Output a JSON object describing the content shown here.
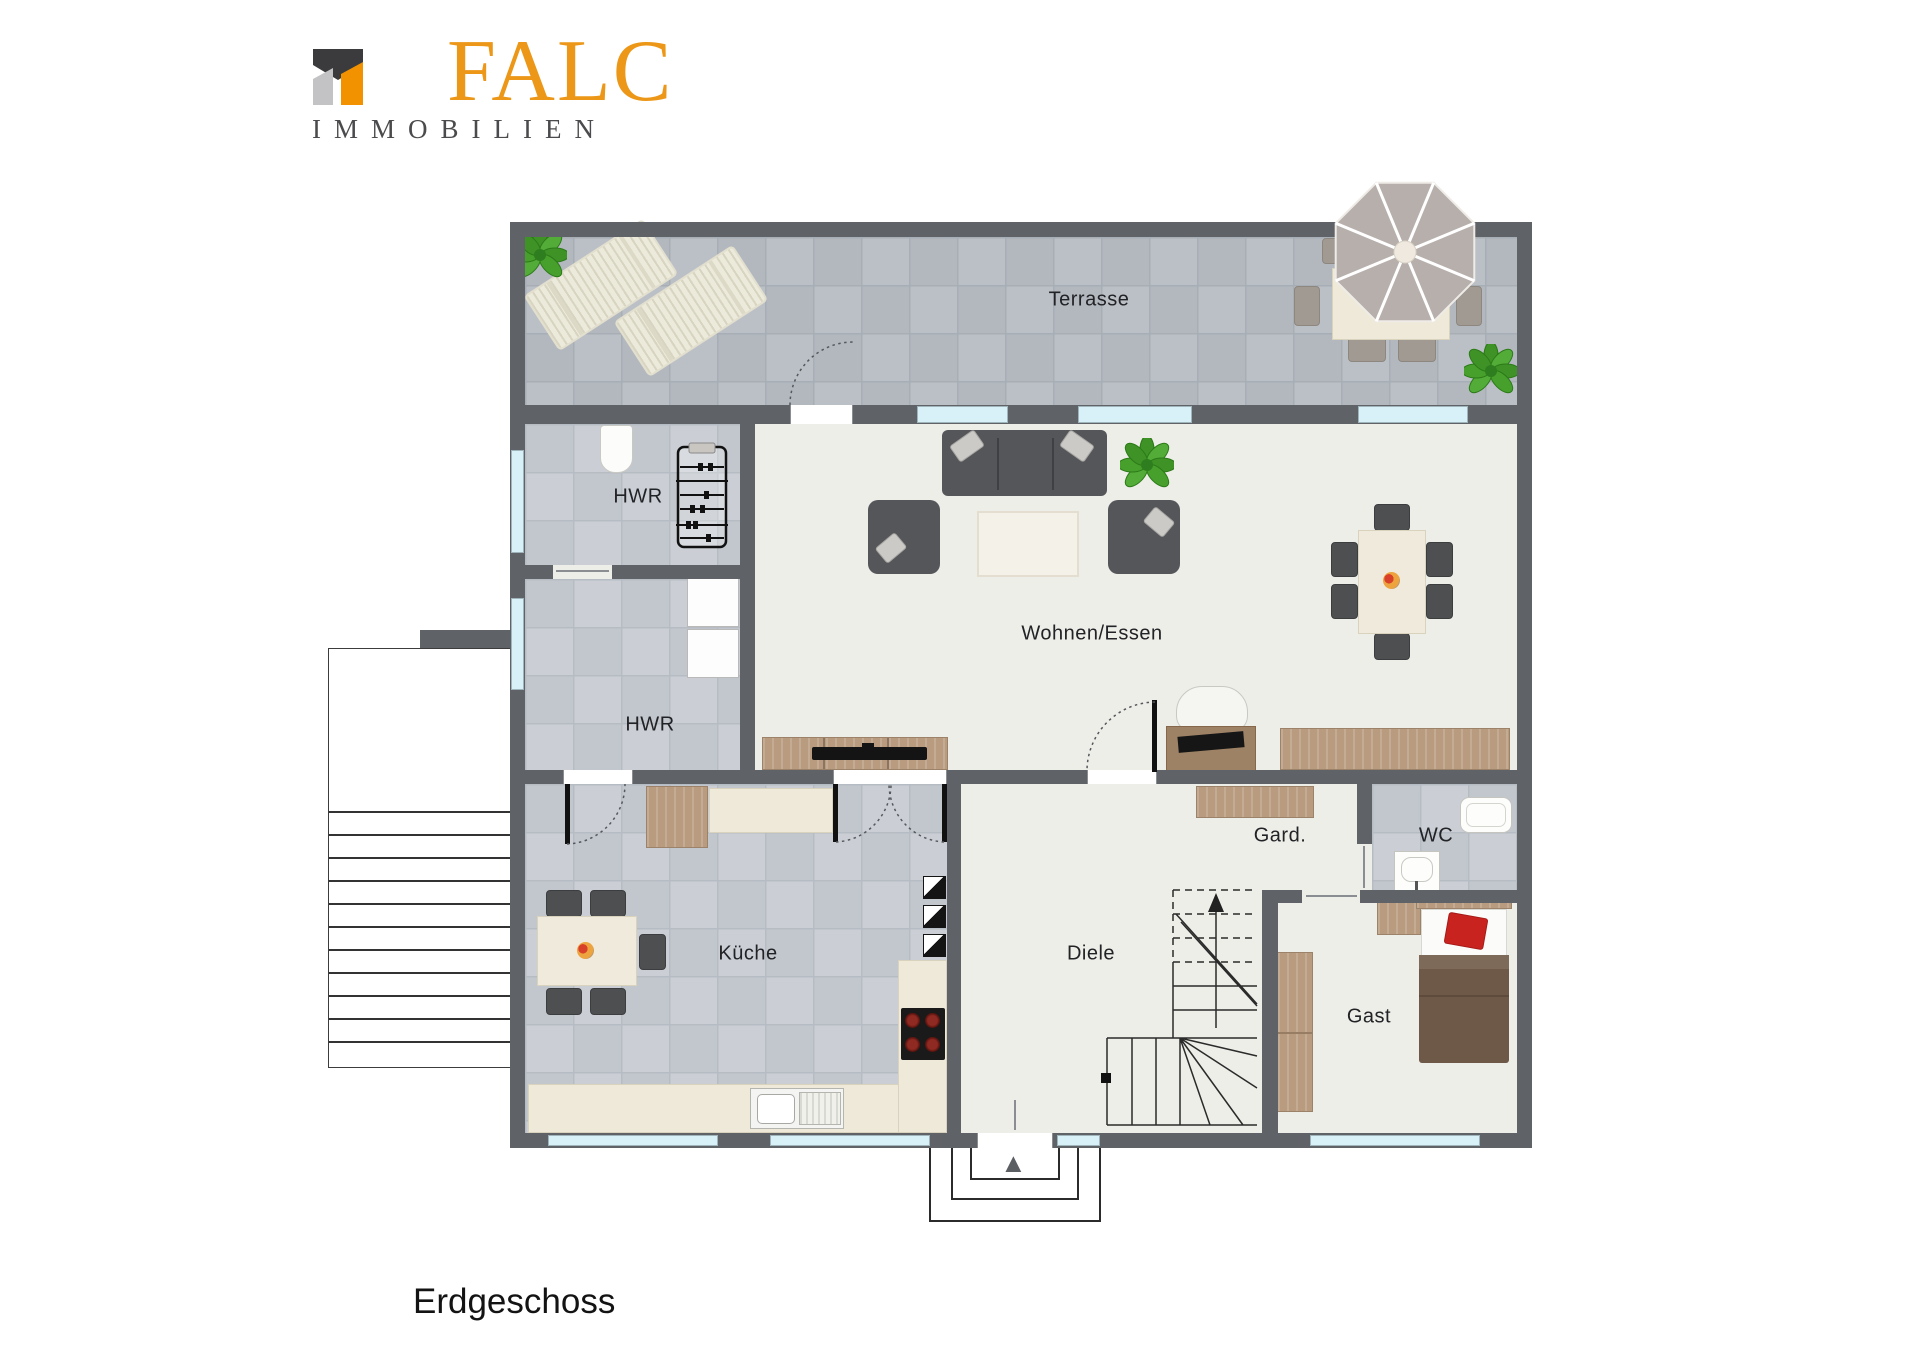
{
  "brand": {
    "name": "FALC",
    "subtitle": "IMMOBILIEN"
  },
  "floor": {
    "label": "Erdgeschoss"
  },
  "rooms": {
    "terrasse": "Terrasse",
    "hwr_top": "HWR",
    "hwr_bottom": "HWR",
    "wohnen_essen": "Wohnen/Essen",
    "kueche": "Küche",
    "diele": "Diele",
    "garderobe": "Gard.",
    "wc": "WC",
    "gast": "Gast"
  },
  "icons": {
    "entrance_arrow": "▲"
  },
  "colors": {
    "brand_orange": "#F39200",
    "brand_dark": "#3B3B3D",
    "brand_gray": "#C3C3C5",
    "wall": "#5F6267",
    "window_blue": "#D8F0F7",
    "floor_cream": "#EDEEE8",
    "tile_gray": "#C6CAD0",
    "wood": "#B99C80",
    "plant_green": "#47A02C",
    "accent_red": "#C9231F"
  }
}
